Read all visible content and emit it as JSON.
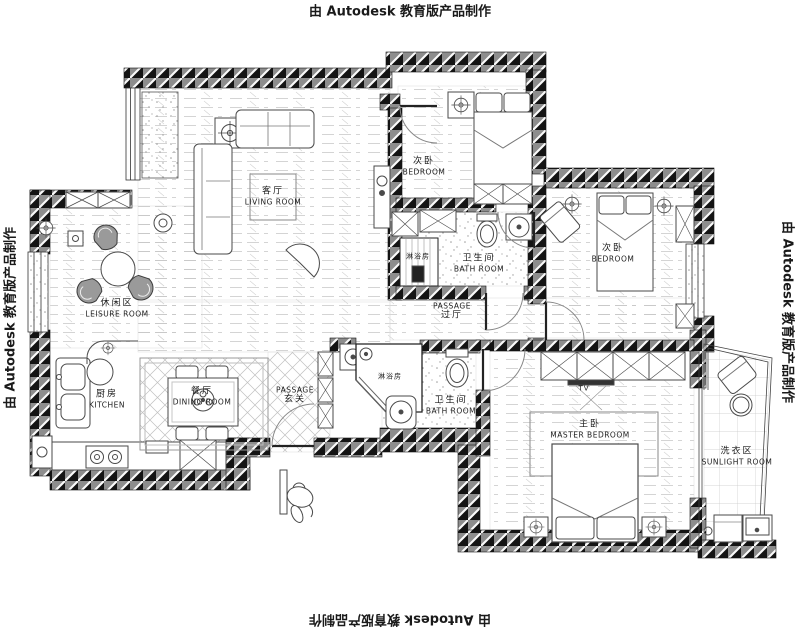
{
  "watermarks": {
    "top": "由 Autodesk 教育版产品制作",
    "bottom": "由 Autodesk 教育版产品制作",
    "left": "由 Autodesk 教育版产品制作",
    "right": "由 Autodesk 教育版产品制作"
  },
  "rooms": {
    "living": {
      "zh": "客厅",
      "en": "LIVING ROOM"
    },
    "bedroom_top": {
      "zh": "次卧",
      "en": "BEDROOM"
    },
    "bedroom_right": {
      "zh": "次卧",
      "en": "BEDROOM"
    },
    "leisure": {
      "zh": "休闲区",
      "en": "LEISURE ROOM"
    },
    "kitchen": {
      "zh": "厨房",
      "en": "KITCHEN"
    },
    "dining": {
      "zh": "餐厅",
      "en": "DINING ROOM"
    },
    "entry": {
      "en": "PASSAGE",
      "zh": "玄关"
    },
    "hall": {
      "en": "PASSAGE",
      "zh": "过厅"
    },
    "bath_top": {
      "zh": "卫生间",
      "en": "BATH ROOM"
    },
    "bath_bottom": {
      "zh": "卫生间",
      "en": "BATH ROOM"
    },
    "shower_top": {
      "zh": "淋浴房"
    },
    "shower_bottom": {
      "zh": "淋浴房"
    },
    "master": {
      "zh": "主卧",
      "en": "MASTER BEDROOM"
    },
    "sunlight": {
      "zh": "洗衣区",
      "en": "SUNLIGHT ROOM"
    }
  },
  "annotations": {
    "tv": "TV"
  },
  "colors": {
    "wall_dark": "#141414",
    "wall_mid": "#8d8d8d",
    "floor_line": "#c6c6c6",
    "outline": "#4a4a4a"
  }
}
